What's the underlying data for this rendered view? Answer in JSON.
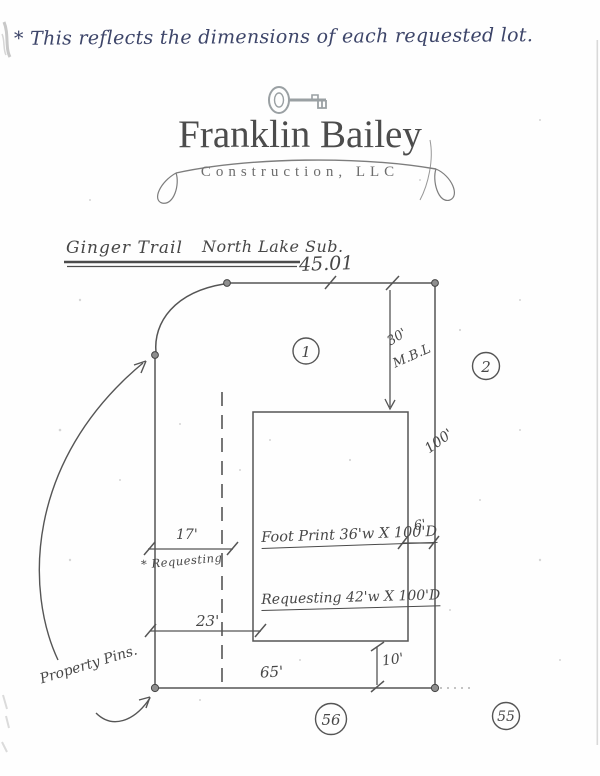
{
  "note": "* This reflects the dimensions of each requested lot.",
  "letterhead": {
    "company_name": "Franklin Bailey",
    "company_subtitle": "Construction, LLC",
    "icon": "skeleton-key-icon"
  },
  "diagram": {
    "title_street": "Ginger Trail",
    "title_subdivision": "North Lake Sub.",
    "dims": {
      "top_width": "45.01",
      "mbl_value": "30'",
      "mbl_abbr": "M.B.L",
      "right_depth": "100'",
      "requesting_offset": "17'",
      "requesting_note": "* Requesting",
      "building_offset": "23'",
      "side_gap": "6'",
      "rear_gap": "10'",
      "bottom_width": "65'"
    },
    "texts": {
      "footprint": "Foot Print 36'w X 100'D",
      "requesting": "Requesting 42'w X 100'D",
      "property_pins": "Property Pins."
    },
    "lot_numbers": {
      "lot_left": "1",
      "lot_right": "2",
      "lot_bottom_center": "56",
      "lot_bottom_right": "55"
    }
  },
  "colors": {
    "ink": "#4f4f4f",
    "note_ink": "#3d4569",
    "letterhead_ink": "#4c4c4c",
    "pin_fill": "#8f8f8f"
  }
}
